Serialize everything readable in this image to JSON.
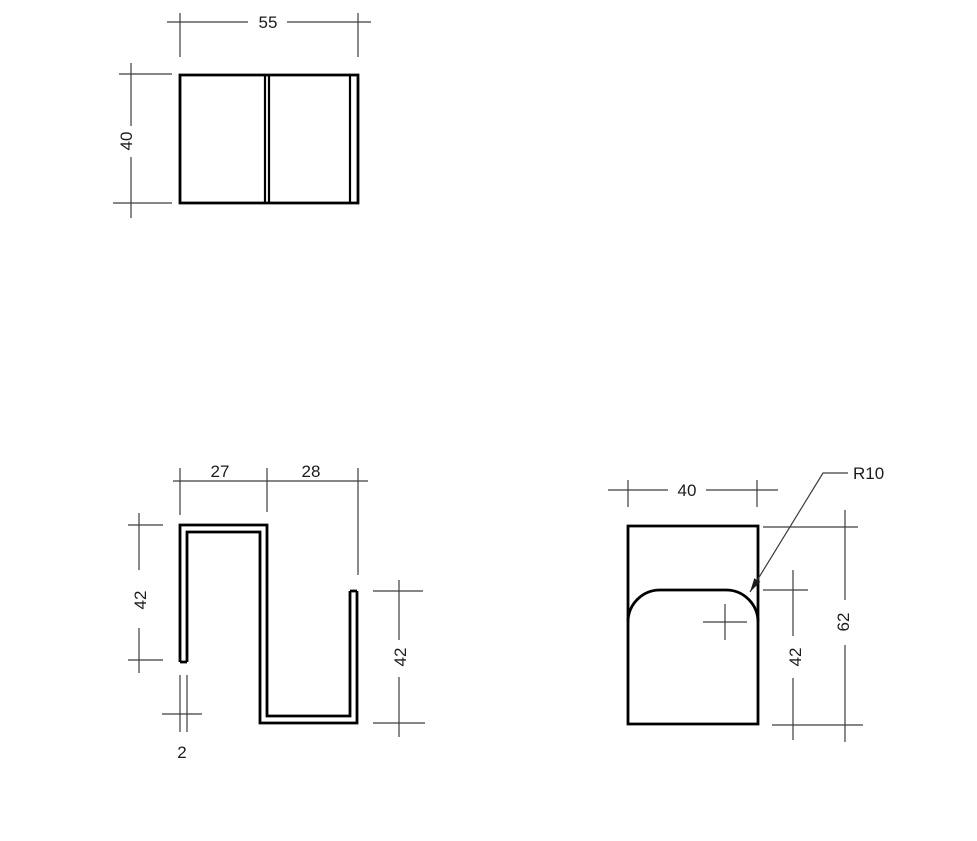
{
  "drawing": {
    "type": "engineering-drawing",
    "description": "Three orthographic views of a 2 mm sheet-metal S-profile bracket",
    "colors": {
      "background": "#ffffff",
      "part_line": "#000000",
      "dimension_line": "#3d3d3d",
      "text": "#1c1c1c"
    },
    "views": {
      "top": {
        "dim_width": "55",
        "dim_height": "40"
      },
      "front": {
        "dim_segment_left": "27",
        "dim_segment_right": "28",
        "dim_height_left": "42",
        "dim_height_right": "42",
        "dim_thickness": "2"
      },
      "side": {
        "dim_width": "40",
        "dim_inner_height": "42",
        "dim_height": "62",
        "dim_radius": "R10"
      }
    }
  }
}
